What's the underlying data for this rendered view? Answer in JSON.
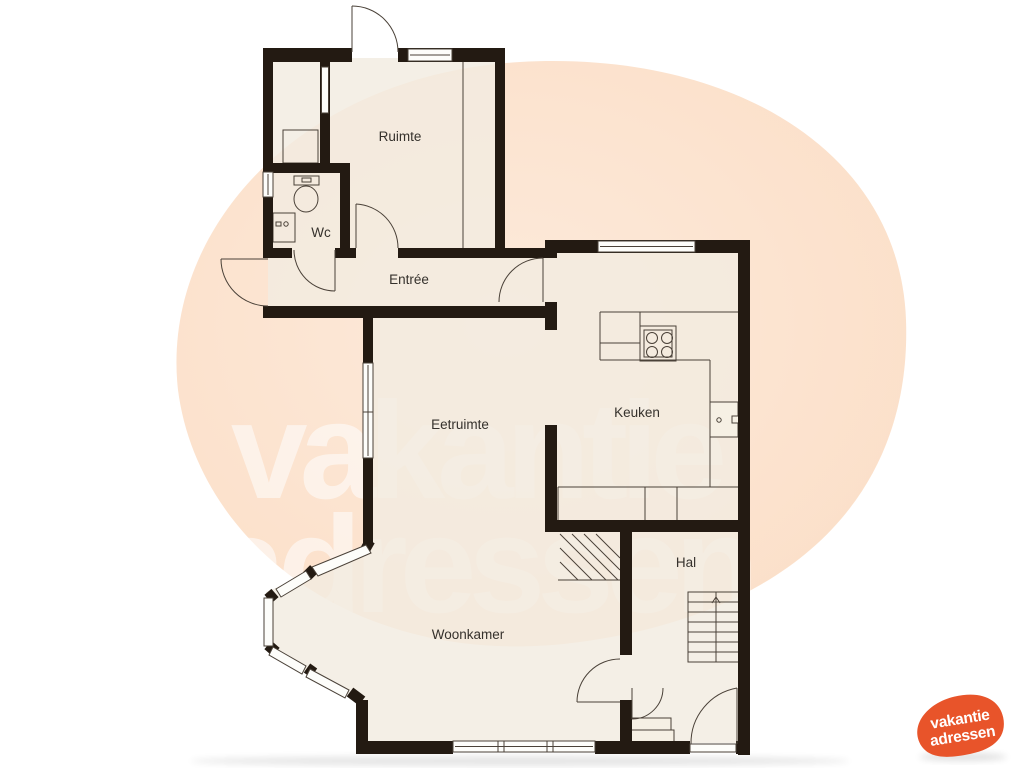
{
  "title": "Plattegrond begane grond",
  "rooms": [
    {
      "id": "ruimte",
      "label": "Ruimte"
    },
    {
      "id": "wc",
      "label": "Wc"
    },
    {
      "id": "entree",
      "label": "Entrée"
    },
    {
      "id": "eetruimte",
      "label": "Eetruimte"
    },
    {
      "id": "keuken",
      "label": "Keuken"
    },
    {
      "id": "hal",
      "label": "Hal"
    },
    {
      "id": "woonkamer",
      "label": "Woonkamer"
    }
  ],
  "watermark": {
    "line1": "vakantie",
    "line2": "adressen",
    "color": "#ffffff"
  },
  "logo": {
    "line1": "vakantie",
    "line2": "adressen",
    "blob_color": "#e8542a",
    "text_color": "#ffffff"
  },
  "fixtures": [
    "toilet",
    "sink",
    "stove",
    "kitchen-counter",
    "boiler",
    "stairs-up",
    "entry-step",
    "under-stairs-hatch"
  ],
  "colors": {
    "wall": "#231a12",
    "thin_line": "#4a4138",
    "floor": "#f2ecde",
    "background_blob": "#fbe1cc",
    "page_background": "#ffffff"
  }
}
